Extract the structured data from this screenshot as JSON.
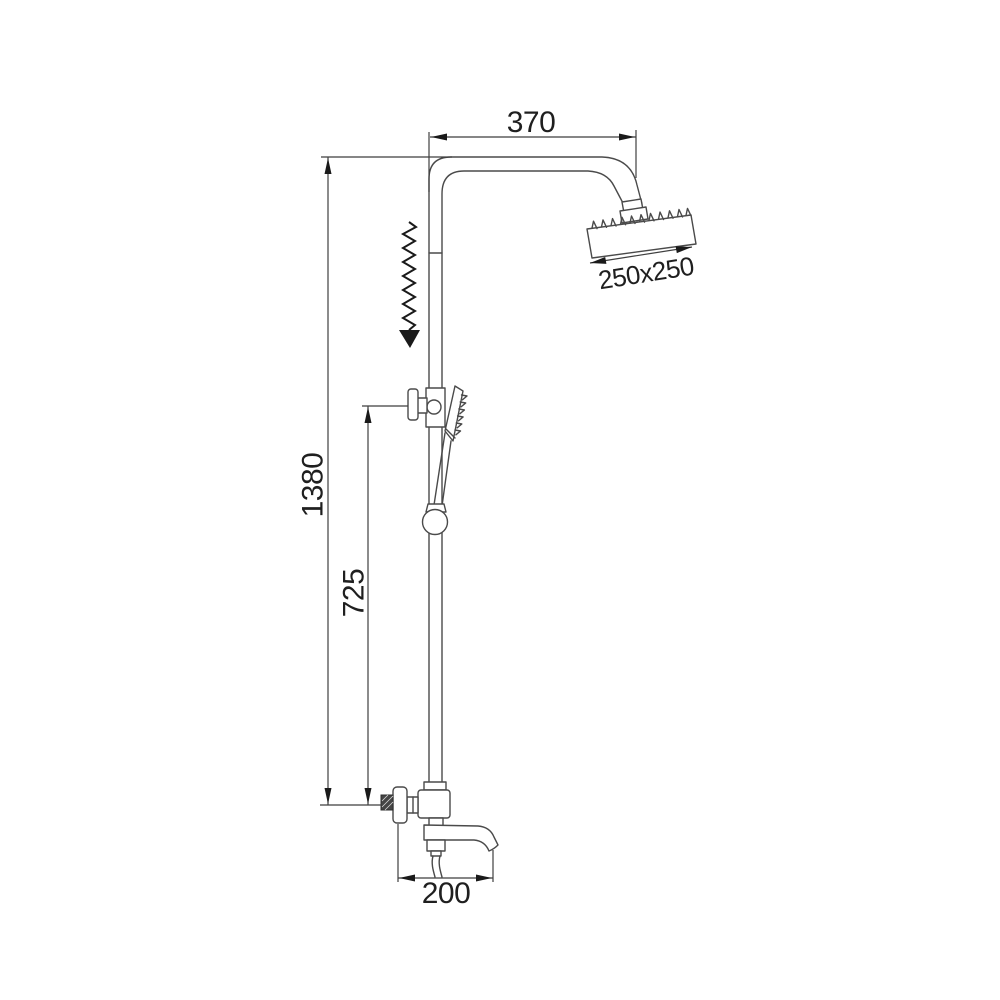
{
  "drawing": {
    "labels": {
      "top_width": "370",
      "head_size": "250x250",
      "total_height": "1380",
      "mid_height": "725",
      "spout_width": "200"
    },
    "colors": {
      "background": "#ffffff",
      "fixture_outline": "#4a4a4a",
      "dimension_lines": "#3f3f3f",
      "arrows_and_text": "#1a1a1a"
    }
  }
}
